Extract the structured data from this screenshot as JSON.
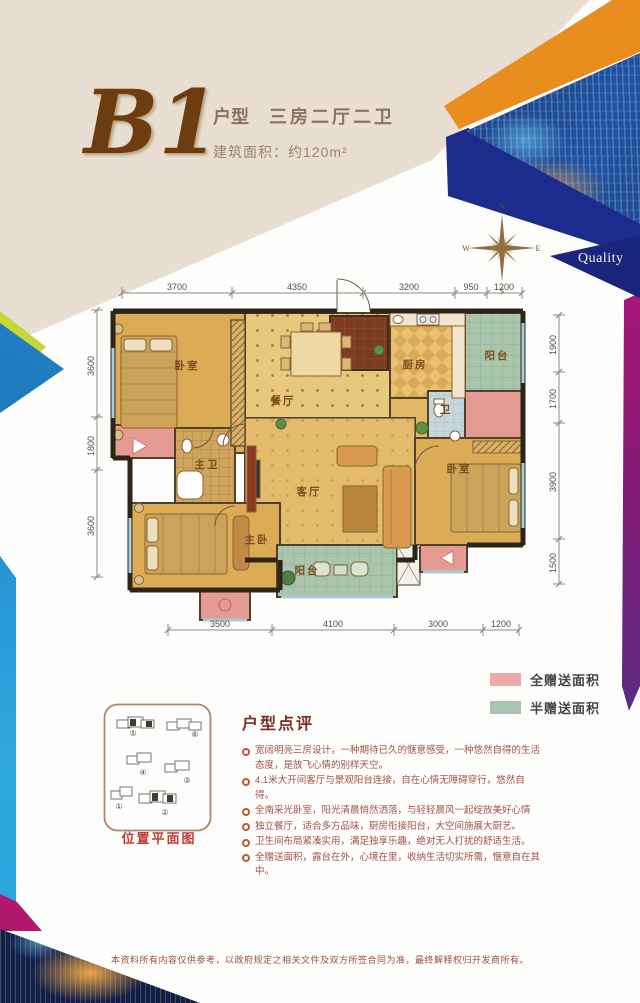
{
  "title": {
    "unit": "B1",
    "type_label": "户型",
    "layout": "三房二厅二卫",
    "area": "建筑面积：约120m²"
  },
  "corner_badge": {
    "quality": "Quality"
  },
  "compass": {
    "north": "N",
    "east": "E",
    "south": "S",
    "west": "W"
  },
  "floorplan": {
    "dims_top": [
      "3700",
      "4350",
      "3200",
      "950",
      "1200"
    ],
    "dims_bottom": [
      "3500",
      "4100",
      "3000",
      "1200"
    ],
    "dims_left": [
      "3600",
      "1800",
      "3600"
    ],
    "dims_right": [
      "1900",
      "1700",
      "3900",
      "1500"
    ],
    "rooms": [
      "卧室",
      "餐厅",
      "厨房",
      "阳台",
      "卫",
      "主卫",
      "客厅",
      "卧室",
      "主卧",
      "阳台"
    ]
  },
  "legend": {
    "items": [
      {
        "label": "全赠送面积",
        "color": "#eeaca9"
      },
      {
        "label": "半赠送面积",
        "color": "#a9c3b0"
      }
    ]
  },
  "location": {
    "caption": "位置平面图",
    "buildings": [
      "①",
      "②",
      "③",
      "④",
      "⑤",
      "⑥"
    ]
  },
  "review": {
    "title": "户型点评",
    "bullets": [
      "宽阔明亮三房设计，一种期待已久的惬意感受，一种悠然自得的生活态度，是放飞心情的别样天空。",
      "4.1米大开间客厅与景观阳台连接，自在心情无障碍穿行，悠然自得。",
      "全南采光卧室，阳光清晨悄然洒落，与轻轻晨风一起绽放美好心情",
      "独立餐厅，适合多方品味，厨房衔接阳台，大空间施展大厨艺。",
      "卫生间布局紧凑实用，满足独享乐趣，绝对无人打扰的舒适生活。",
      "全赠送面积，露台在外，心境在里，收纳生活切实所需，惬意自在其中。"
    ]
  },
  "disclaimer": "本资料所有内容仅供参考，以政府规定之相关文件及双方所签合同为准，最终解释权归开发商所有。"
}
